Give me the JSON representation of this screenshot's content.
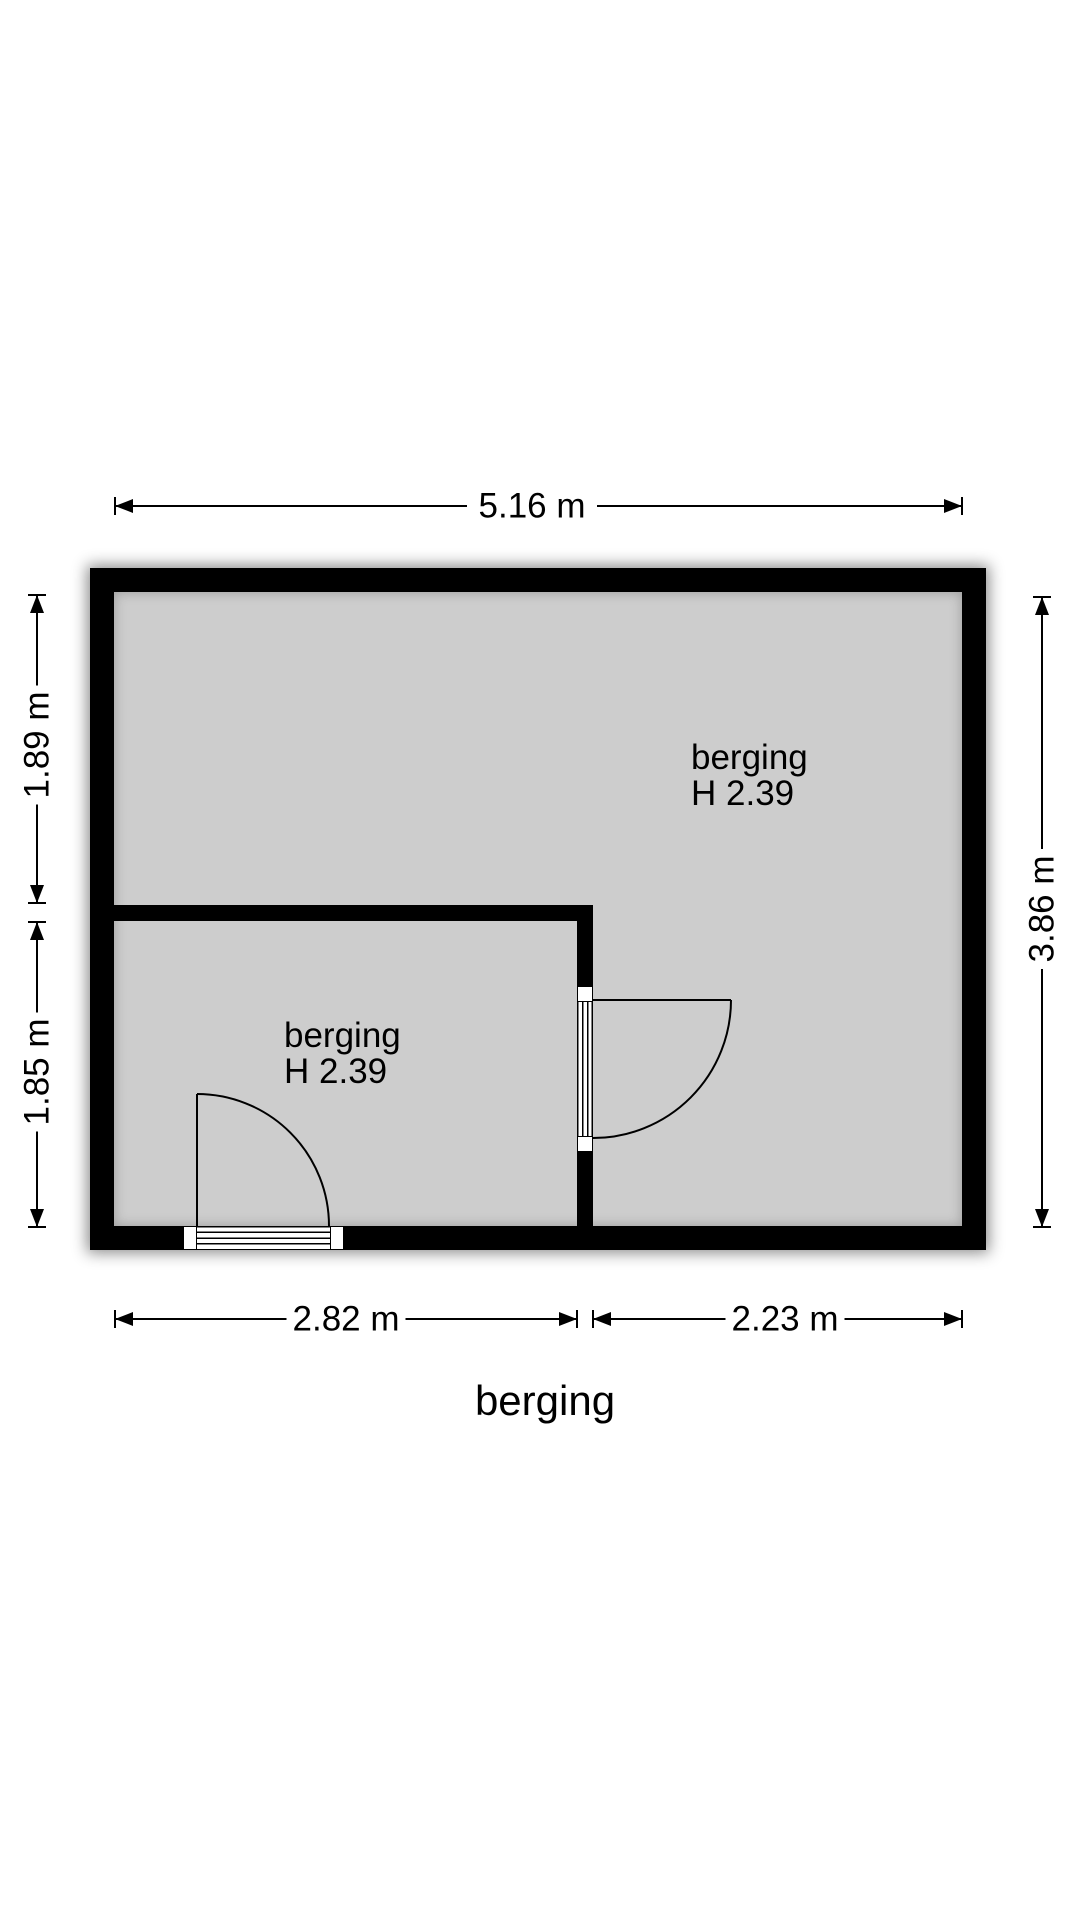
{
  "floorplan": {
    "title": "berging",
    "colors": {
      "wall": "#000000",
      "floor": "#cdcdcd",
      "line": "#000000",
      "text": "#000000",
      "bg": "#ffffff"
    },
    "rooms": [
      {
        "name": "berging",
        "height_label": "H 2.39"
      },
      {
        "name": "berging",
        "height_label": "H 2.39"
      }
    ],
    "dimensions": {
      "top": "5.16 m",
      "right": "3.86 m",
      "left_upper": "1.89 m",
      "left_lower": "1.85 m",
      "bottom_left": "2.82 m",
      "bottom_right": "2.23 m"
    }
  }
}
